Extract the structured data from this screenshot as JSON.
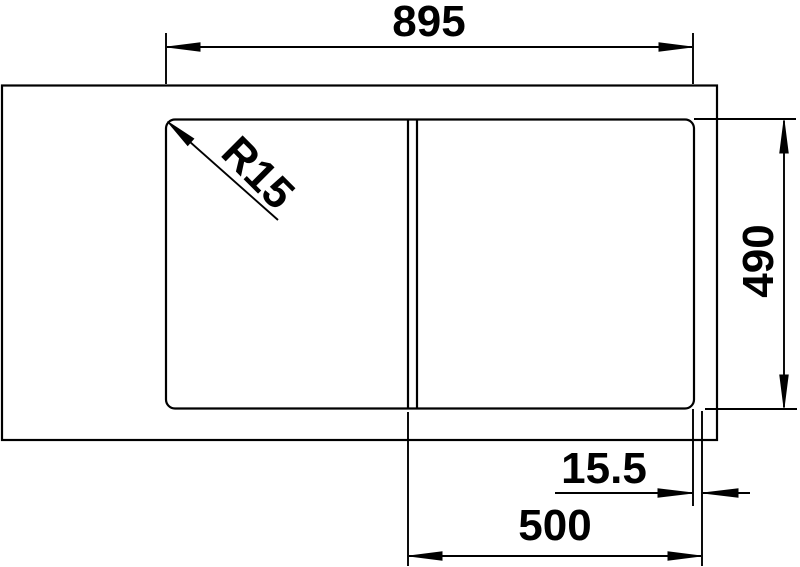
{
  "page": {
    "background_color": "#ffffff"
  },
  "drawing": {
    "kind": "technical-dimension-drawing",
    "subject": "sink-top-view",
    "stroke_color": "#000000",
    "labels": {
      "overall_width": "895",
      "depth": "490",
      "offset": "15.5",
      "bowl_width": "500",
      "corner_radius": "R15"
    }
  }
}
